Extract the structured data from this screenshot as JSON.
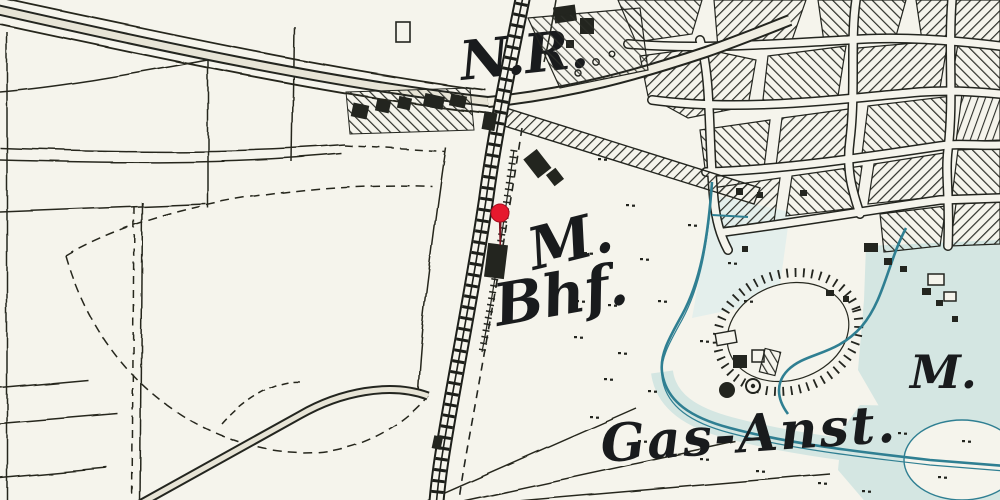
{
  "map": {
    "kind": "historical-topographic-map",
    "labels": {
      "north_abbrev": "N.R.",
      "station_initial": "M.",
      "station_abbrev": "Bhf.",
      "gasworks": "Gas-Anst.",
      "locality_abbrev": "M."
    },
    "marker": {
      "name": "station-location-pin",
      "color": "#e6192e",
      "stem_color": "#7d1420"
    },
    "palette": {
      "paper": "#f5f4ec",
      "ink": "#23251f",
      "water_fill": "#d4e6e2",
      "water_line": "#2f7f92",
      "road_fill": "#e7e4d6"
    }
  }
}
